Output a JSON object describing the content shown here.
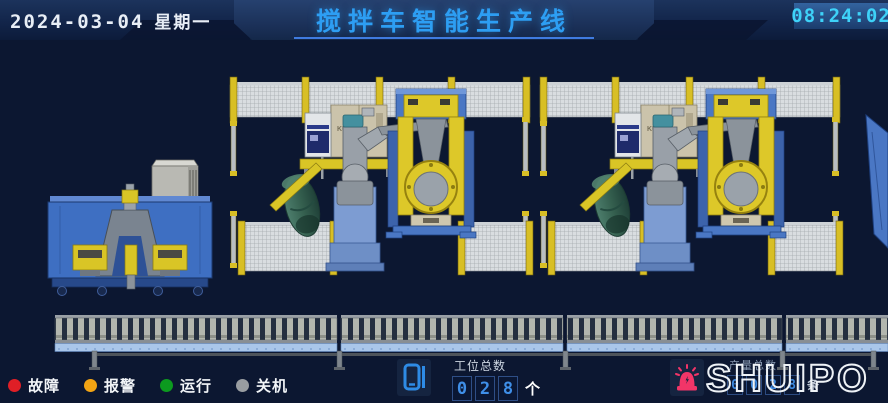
{
  "header": {
    "date": "2024-03-04",
    "weekday": "星期一",
    "title": "搅拌车智能生产线",
    "time": "08:24:02"
  },
  "scene": {
    "robot_brand": "KUKA"
  },
  "legend": {
    "items": [
      {
        "label": "故障",
        "color": "#e01f26"
      },
      {
        "label": "报警",
        "color": "#f2a414"
      },
      {
        "label": "运行",
        "color": "#0c9a1f"
      },
      {
        "label": "关机",
        "color": "#999da1"
      }
    ]
  },
  "station_counter": {
    "label": "工位总数",
    "digits": [
      "0",
      "2",
      "8"
    ],
    "unit": "个"
  },
  "production_counter": {
    "label": "产量总数",
    "digits": [
      "0",
      "0",
      "2",
      "8"
    ],
    "unit": "条"
  },
  "logo": {
    "text": "SHUIPO"
  },
  "icons": {
    "station": "tablet-counter-icon",
    "alarm": "alarm-beacon-icon"
  },
  "colors": {
    "accent_blue": "#2d9ef3",
    "time_cyan": "#3ed2f8",
    "digit_blue": "#3f8fe8",
    "fence_yellow": "#d8bf25",
    "machine_blue": "#3e6fc2",
    "drum_green": "#35604f"
  }
}
